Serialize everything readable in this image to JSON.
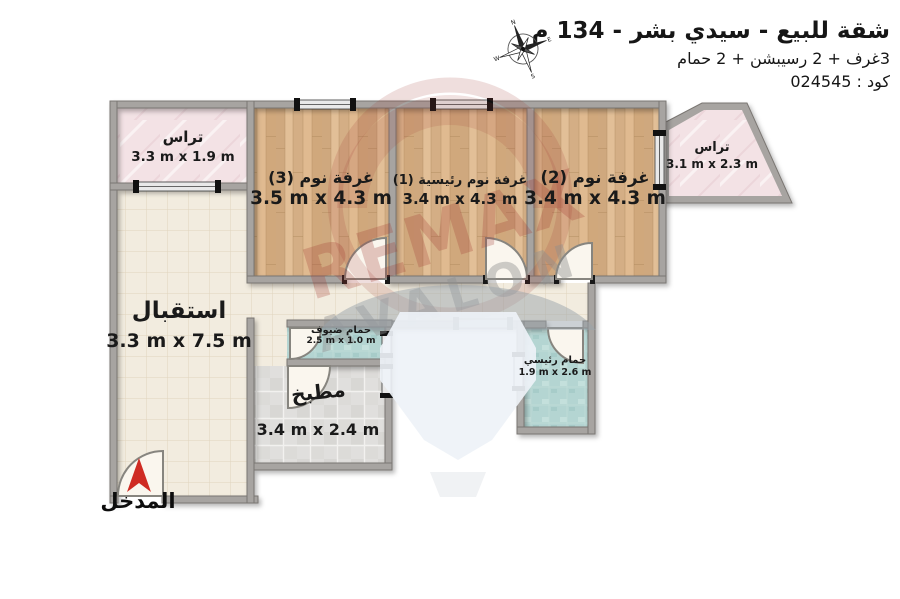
{
  "header": {
    "title": "شقة للبيع - سيدي بشر - 134 م",
    "subtitle": "3غرف + 2 رسيبشن + 2 حمام",
    "code": "كود : 024545"
  },
  "compass": {
    "n": "N",
    "e": "E",
    "s": "S",
    "w": "W"
  },
  "rooms": [
    {
      "id": "terrace-left",
      "name": "تراس",
      "dims": "3.3 m x 1.9 m"
    },
    {
      "id": "bedroom-3",
      "name": "غرفة نوم (3)",
      "dims": "3.5 m x 4.3 m"
    },
    {
      "id": "master-bedroom-1",
      "name": "غرفة نوم رئيسية (1)",
      "dims": "3.4 m x 4.3 m"
    },
    {
      "id": "bedroom-2",
      "name": "غرفة نوم (2)",
      "dims": "3.4 m x 4.3 m"
    },
    {
      "id": "terrace-right",
      "name": "تراس",
      "dims": "3.1 m x 2.3 m"
    },
    {
      "id": "reception",
      "name": "استقبال",
      "dims": "3.3 m x 7.5 m"
    },
    {
      "id": "guest-bathroom",
      "name": "حمام ضيوف",
      "dims": "2.5 m x 1.0 m"
    },
    {
      "id": "kitchen",
      "name": "مطبخ",
      "dims": "3.4 m x 2.4 m"
    },
    {
      "id": "master-bathroom",
      "name": "حمام رئيسي",
      "dims": "1.9 m x 2.6 m"
    }
  ],
  "entrance": {
    "label": "المدخل"
  },
  "watermark": {
    "brand": "REMAX",
    "sub": "AVALON"
  },
  "colors": {
    "wood": "#d9b48c",
    "tile": "#f2ecdf",
    "kitchen": "#e0dfdd",
    "bath": "#b4d5d2",
    "terrace": "#f3e2e5",
    "wall": "#a7a4a1",
    "accent_red": "#cf2b23",
    "watermark_red": "#a23a32"
  }
}
